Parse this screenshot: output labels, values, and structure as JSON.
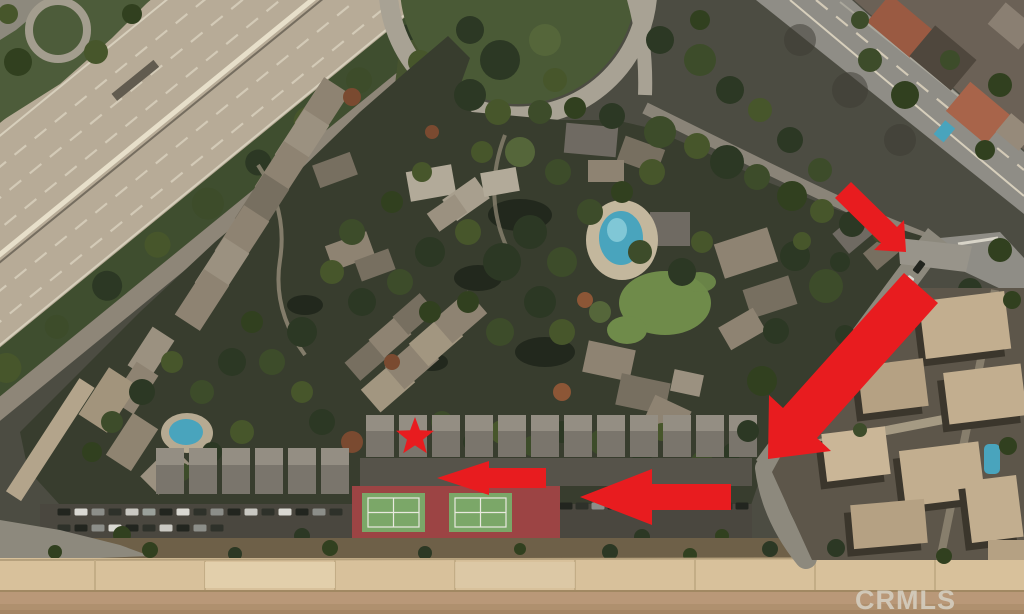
{
  "watermark": {
    "text": "CRMLS"
  },
  "annotations": {
    "color": "#e81c1f"
  },
  "scene": {
    "colors": {
      "freeway_pavement": "#b7ab97",
      "arterial_road": "#8f8d86",
      "local_road": "#8d897d",
      "complex_ground": "#383d2e",
      "pool_water": "#49a4bd",
      "lawn": "#6f8b4a",
      "tennis_pad": "#9c4444",
      "tennis_court": "#7ba768",
      "channel_bank": "#d8c19b",
      "channel_bed": "#b99878",
      "right_complex_roof": "#c2ae8f"
    }
  }
}
